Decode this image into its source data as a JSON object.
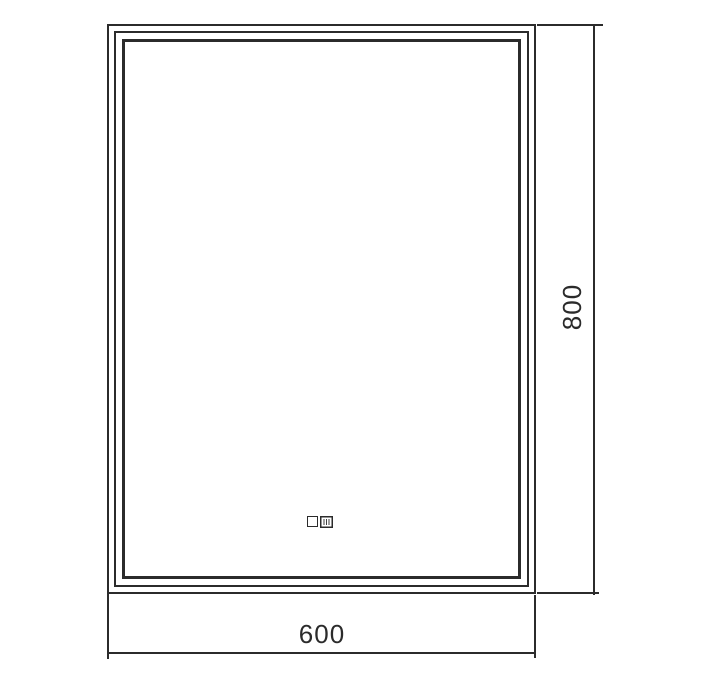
{
  "drawing": {
    "kind": "technical-dimension-drawing",
    "dimensions": {
      "width_label": "600",
      "height_label": "800"
    },
    "icons": {
      "left": "touch-sensor-icon",
      "right": "clock-display-icon"
    },
    "colors": {
      "line": "#2b2b2b",
      "background": "#ffffff"
    }
  }
}
